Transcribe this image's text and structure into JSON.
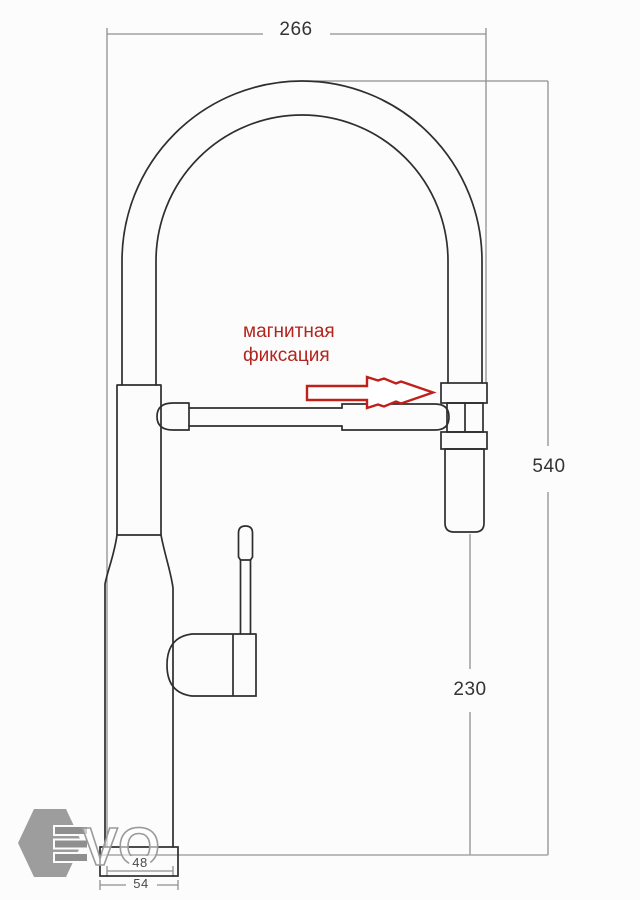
{
  "page": {
    "background": "#fcfcfc"
  },
  "drawing": {
    "type": "technical-drawing",
    "subject": "kitchen faucet with flexible spring spout and magnetic spray-head dock",
    "dimensions": {
      "spout_width": "266",
      "total_height": "540",
      "spray_height": "230",
      "base_top_width": "48",
      "base_bottom_width": "54"
    },
    "annotation": {
      "line1": "магнитная",
      "line2": "фиксация"
    },
    "watermark": {
      "letters": "VO"
    },
    "colors": {
      "outline": "#2e2e2e",
      "dimension": "#8f8f8f",
      "accent_red": "#b3241f",
      "watermark_gray": "#8f8f8f"
    }
  }
}
